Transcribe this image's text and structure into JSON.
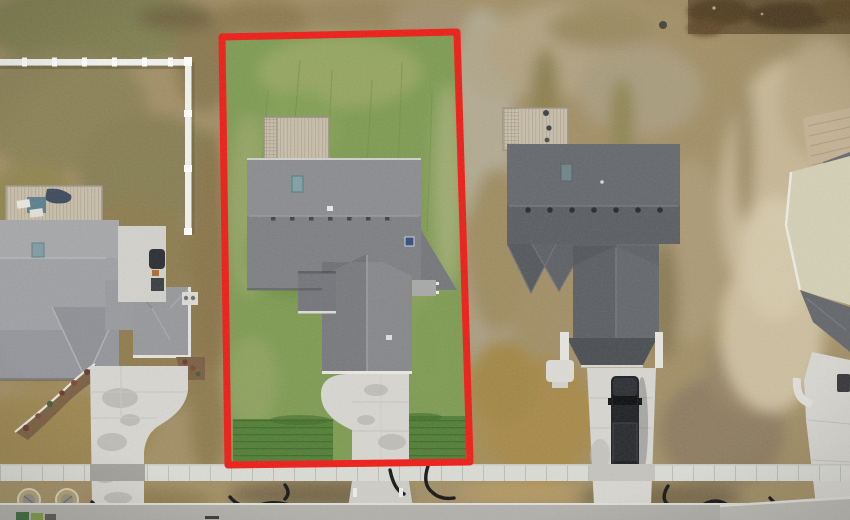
{
  "scene": {
    "type": "aerial-drone-photo",
    "setting": "new-construction suburban street, winter ground cover",
    "highlight": "subject property lot outlined in red"
  },
  "lot": {
    "outline_color": "#ee1c17",
    "outline_width_px": 7,
    "corners_points": "222,37 457,32 470,462 228,465"
  },
  "colors": {
    "dirt_base": "#a28f66",
    "lawn_base": "#7e9b52",
    "lawn_sod": "#517e35",
    "subject_roof_upper": "#8a8c8f",
    "subject_roof_lower": "#7d7f82",
    "subject_wing_left": "#77797d",
    "subject_wing_right": "#85878a",
    "left_roof": "#9fa0a3",
    "right_roof_upper": "#65686c",
    "right_roof_lower": "#5a5d61",
    "deck_wood": "#c8beaa",
    "concrete": "#d7d6d1",
    "sidewalk": "#dbdbd6",
    "street": "#b2b0ab",
    "fence_white": "#f1f1ed",
    "truck_black": "#1b1d20",
    "skylight_glass": "#7fa0a6",
    "mulch": "#7a5f41"
  },
  "objects": [
    {
      "name": "property-boundary",
      "note": "red outlined subject lot with green lawn"
    },
    {
      "name": "subject-house",
      "note": "gray shingle roof, rear deck, front garage wing, concrete driveway"
    },
    {
      "name": "left-house",
      "note": "light gray roof, deck with patio furniture, curved landscaped driveway"
    },
    {
      "name": "right-house",
      "note": "dark charcoal roof, deck, black pickup truck in driveway"
    },
    {
      "name": "far-right-house",
      "note": "partial house at right edge with tan wall and walkway"
    },
    {
      "name": "white-vinyl-fence",
      "note": "L-shaped fence on upper-left lot"
    },
    {
      "name": "sidewalk",
      "note": "concrete sidewalk running across all lots"
    },
    {
      "name": "street",
      "note": "paved road along bottom edge"
    },
    {
      "name": "drainage-pipes",
      "note": "black erosion hoses in parkway strip"
    },
    {
      "name": "manhole-covers",
      "note": "two utility covers lower-left"
    },
    {
      "name": "trash-bins",
      "note": "bins at bottom-left street edge"
    }
  ]
}
